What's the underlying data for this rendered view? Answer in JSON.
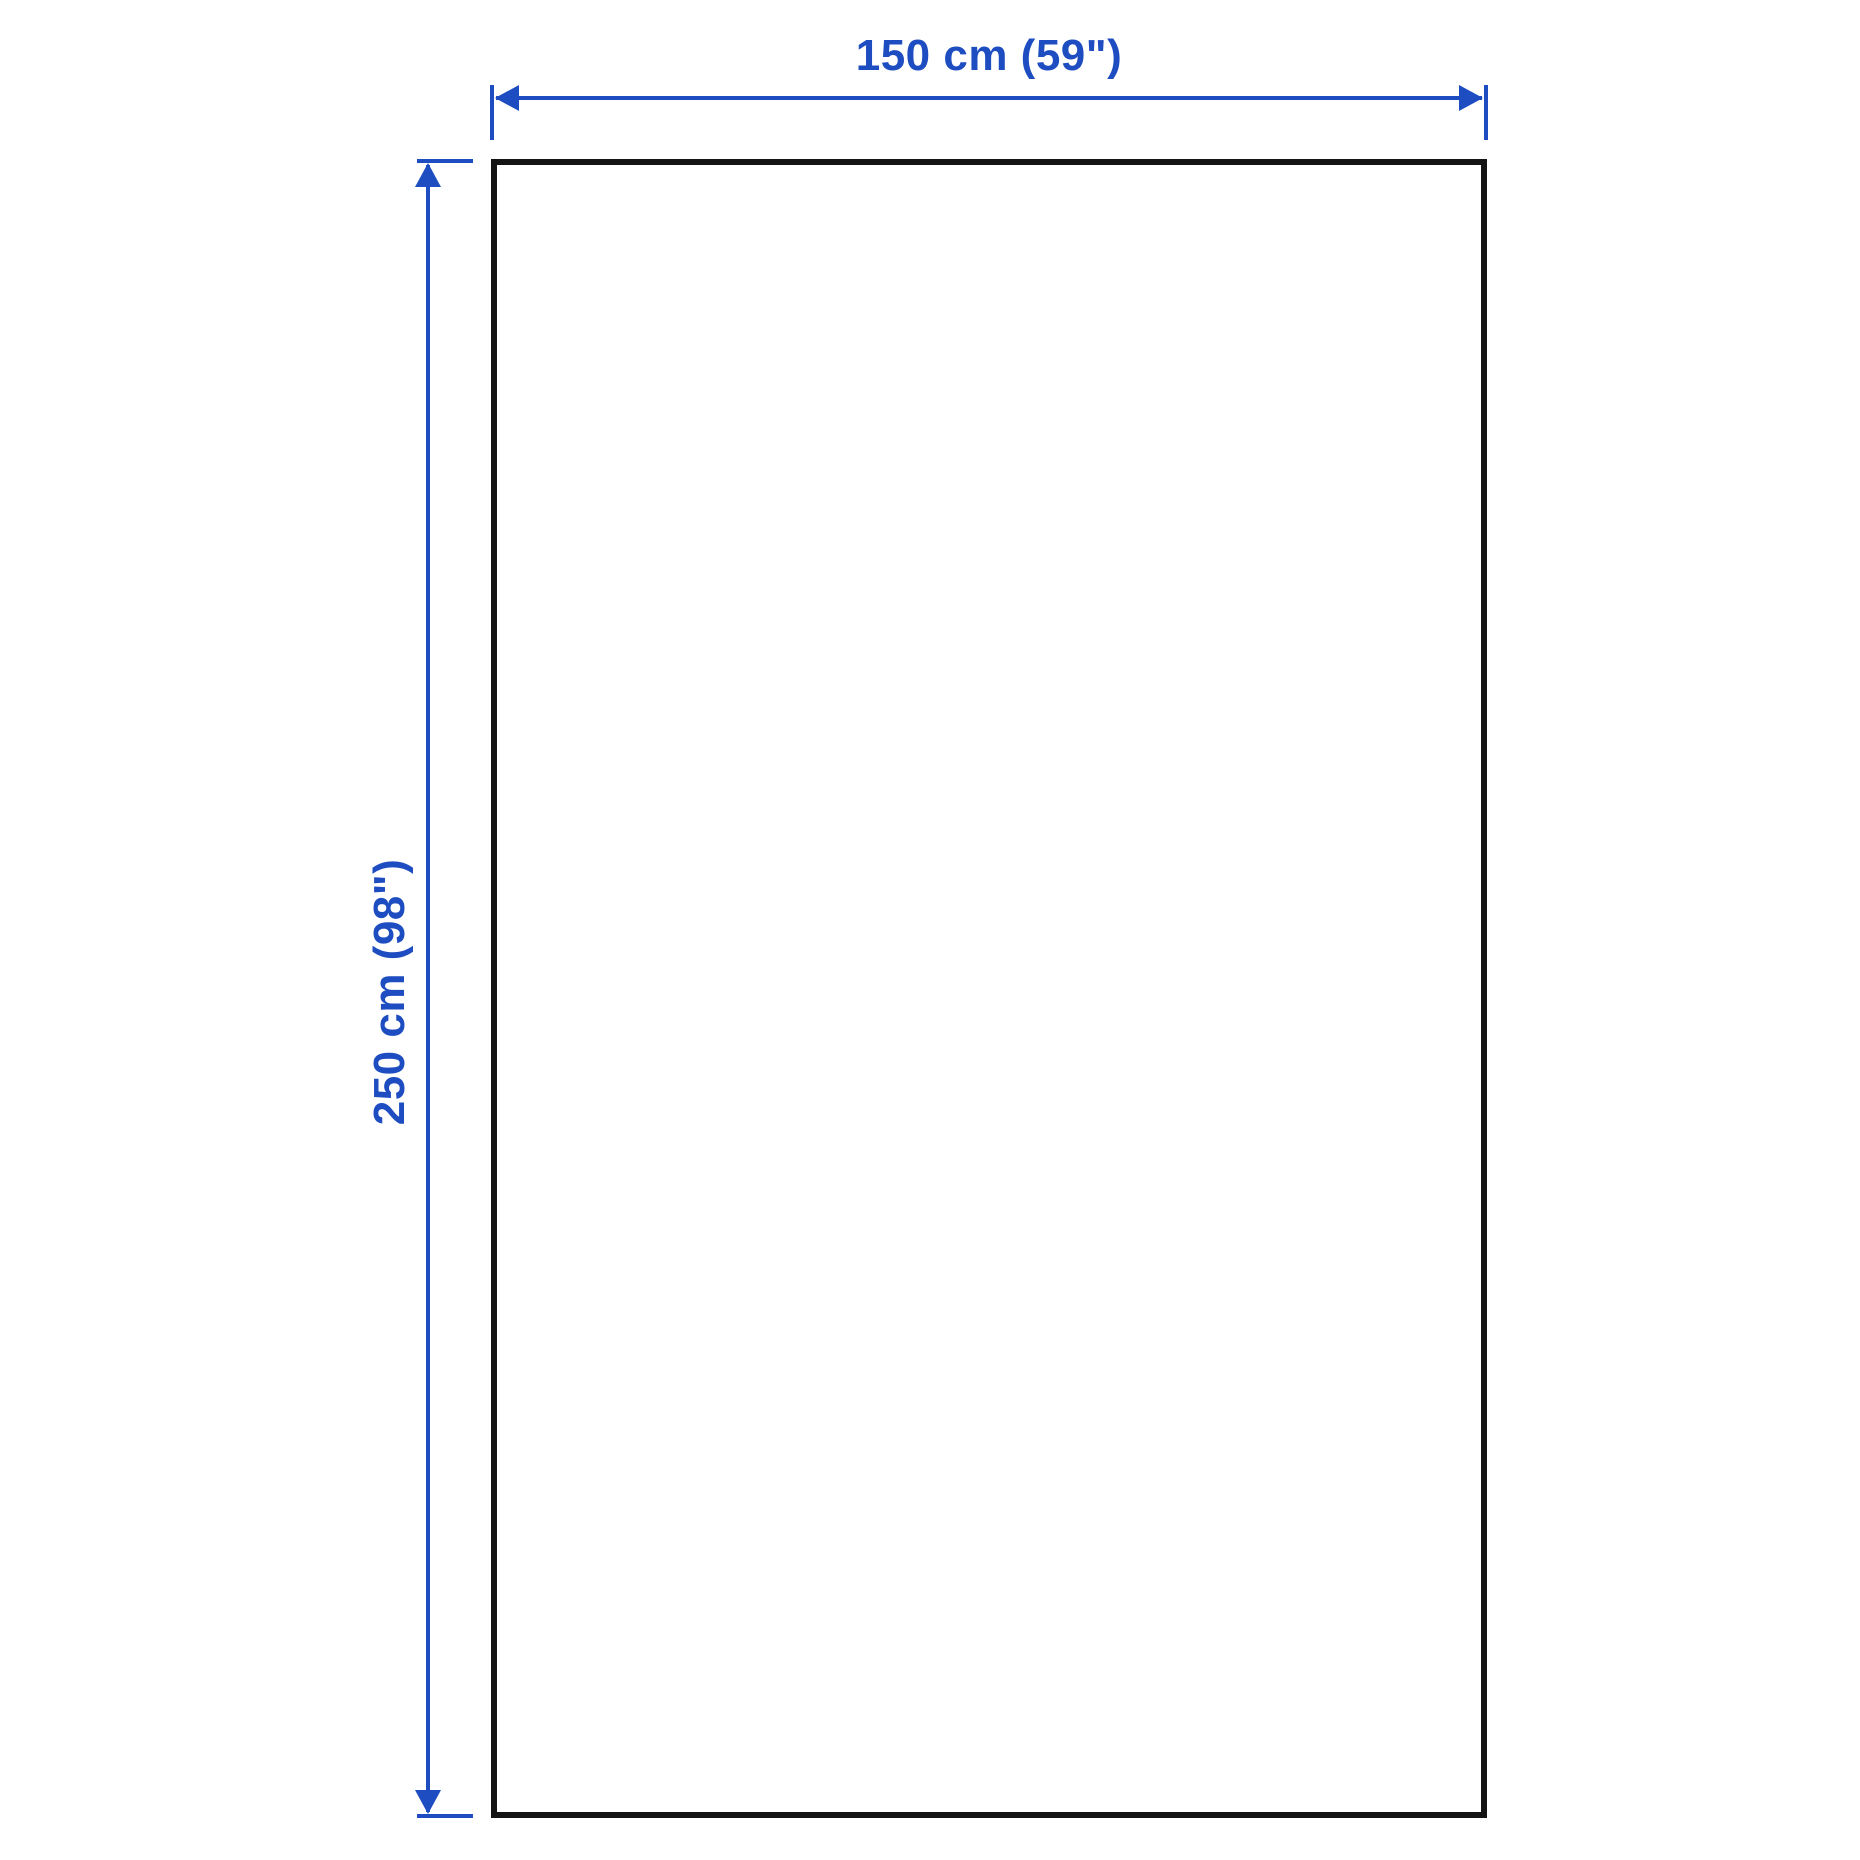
{
  "diagram": {
    "kind": "product-dimension-drawing",
    "accent_color": "#1D4DC0",
    "outline_color": "#141414",
    "background_color": "#ffffff",
    "width_dimension": {
      "label": "150 cm (59\")"
    },
    "height_dimension": {
      "label": "250 cm (98\")"
    }
  }
}
